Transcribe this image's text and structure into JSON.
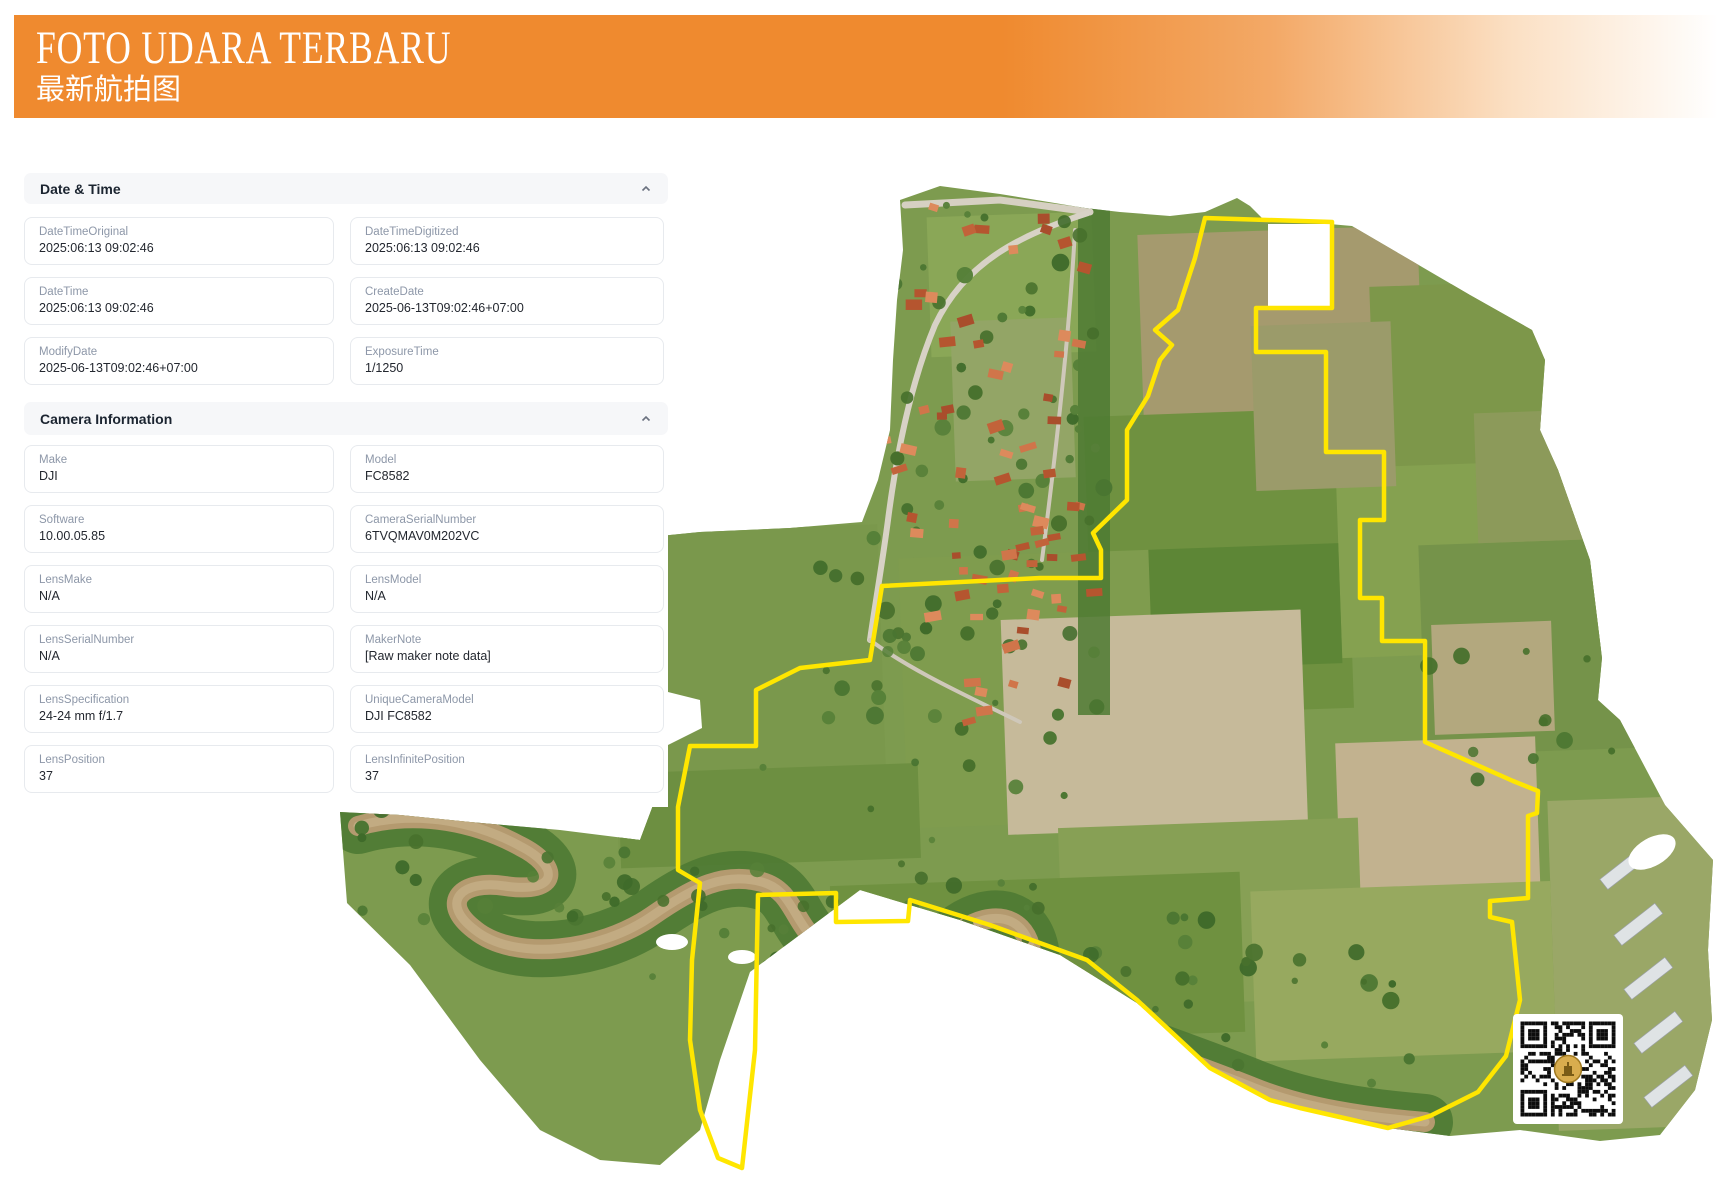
{
  "header": {
    "title": "FOTO UDARA TERBARU",
    "subtitle": "最新航拍图",
    "banner_color": "#ef8a2f"
  },
  "sections": [
    {
      "title": "Date & Time",
      "collapse_icon": "chevron-up",
      "fields": [
        {
          "label": "DateTimeOriginal",
          "value": "2025:06:13 09:02:46"
        },
        {
          "label": "DateTimeDigitized",
          "value": "2025:06:13 09:02:46"
        },
        {
          "label": "DateTime",
          "value": "2025:06:13 09:02:46"
        },
        {
          "label": "CreateDate",
          "value": "2025-06-13T09:02:46+07:00"
        },
        {
          "label": "ModifyDate",
          "value": "2025-06-13T09:02:46+07:00"
        },
        {
          "label": "ExposureTime",
          "value": "1/1250"
        }
      ]
    },
    {
      "title": "Camera Information",
      "collapse_icon": "chevron-up",
      "fields": [
        {
          "label": "Make",
          "value": "DJI"
        },
        {
          "label": "Model",
          "value": "FC8582"
        },
        {
          "label": "Software",
          "value": "10.00.05.85"
        },
        {
          "label": "CameraSerialNumber",
          "value": "6TVQMAV0M202VC"
        },
        {
          "label": "LensMake",
          "value": "N/A"
        },
        {
          "label": "LensModel",
          "value": "N/A"
        },
        {
          "label": "LensSerialNumber",
          "value": "N/A"
        },
        {
          "label": "MakerNote",
          "value": "[Raw maker note data]"
        },
        {
          "label": "LensSpecification",
          "value": "24-24 mm f/1.7"
        },
        {
          "label": "UniqueCameraModel",
          "value": "DJI FC8582"
        },
        {
          "label": "LensPosition",
          "value": "37"
        },
        {
          "label": "LensInfinitePosition",
          "value": "37"
        }
      ]
    }
  ],
  "map": {
    "kind": "drone aerial orthomosaic with survey boundary",
    "boundary_color": "#ffe600",
    "qr": {
      "present": true,
      "logo_color": "#d9ad4e"
    }
  }
}
